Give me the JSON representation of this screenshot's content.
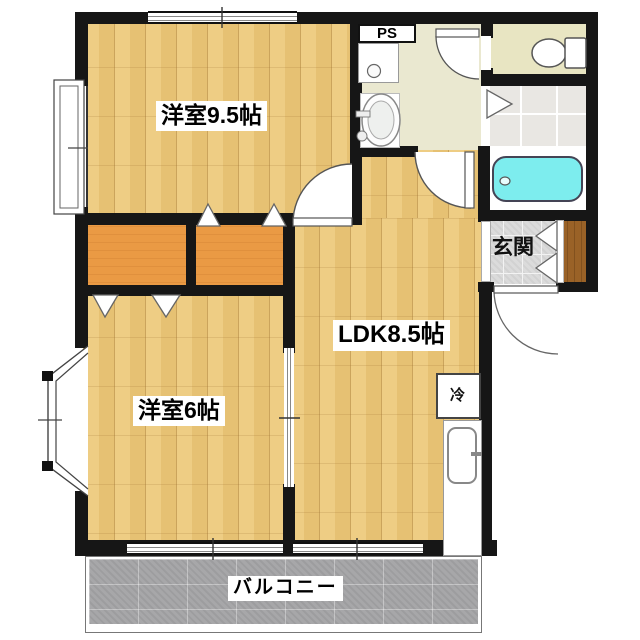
{
  "plan_title": "apartment-floor-plan",
  "rooms": {
    "bedroom1": {
      "label": "洋室9.5帖"
    },
    "bedroom2": {
      "label": "洋室6帖"
    },
    "ldk": {
      "label": "LDK8.5帖"
    },
    "entrance": {
      "label": "玄関"
    },
    "balcony": {
      "label": "バルコニー"
    },
    "pipe_space": {
      "label": "PS"
    },
    "refrigerator": {
      "label": "冷"
    }
  },
  "colors": {
    "wall": "#161616",
    "wood_a": "#eecd84",
    "wood_b": "#e6c173",
    "wood_line": "#cba45c",
    "closet": "#ea9a44",
    "washroom_floor": "#eae8d0",
    "toilet_floor": "#e8e5c2",
    "bath_tile": "#e9e7e3",
    "tub": "#7dedee",
    "genkan_tile": "#dbdbdb",
    "shoe_cabinet": "#9a6227",
    "balcony": "#a7a7a9",
    "outline": "#555555"
  }
}
